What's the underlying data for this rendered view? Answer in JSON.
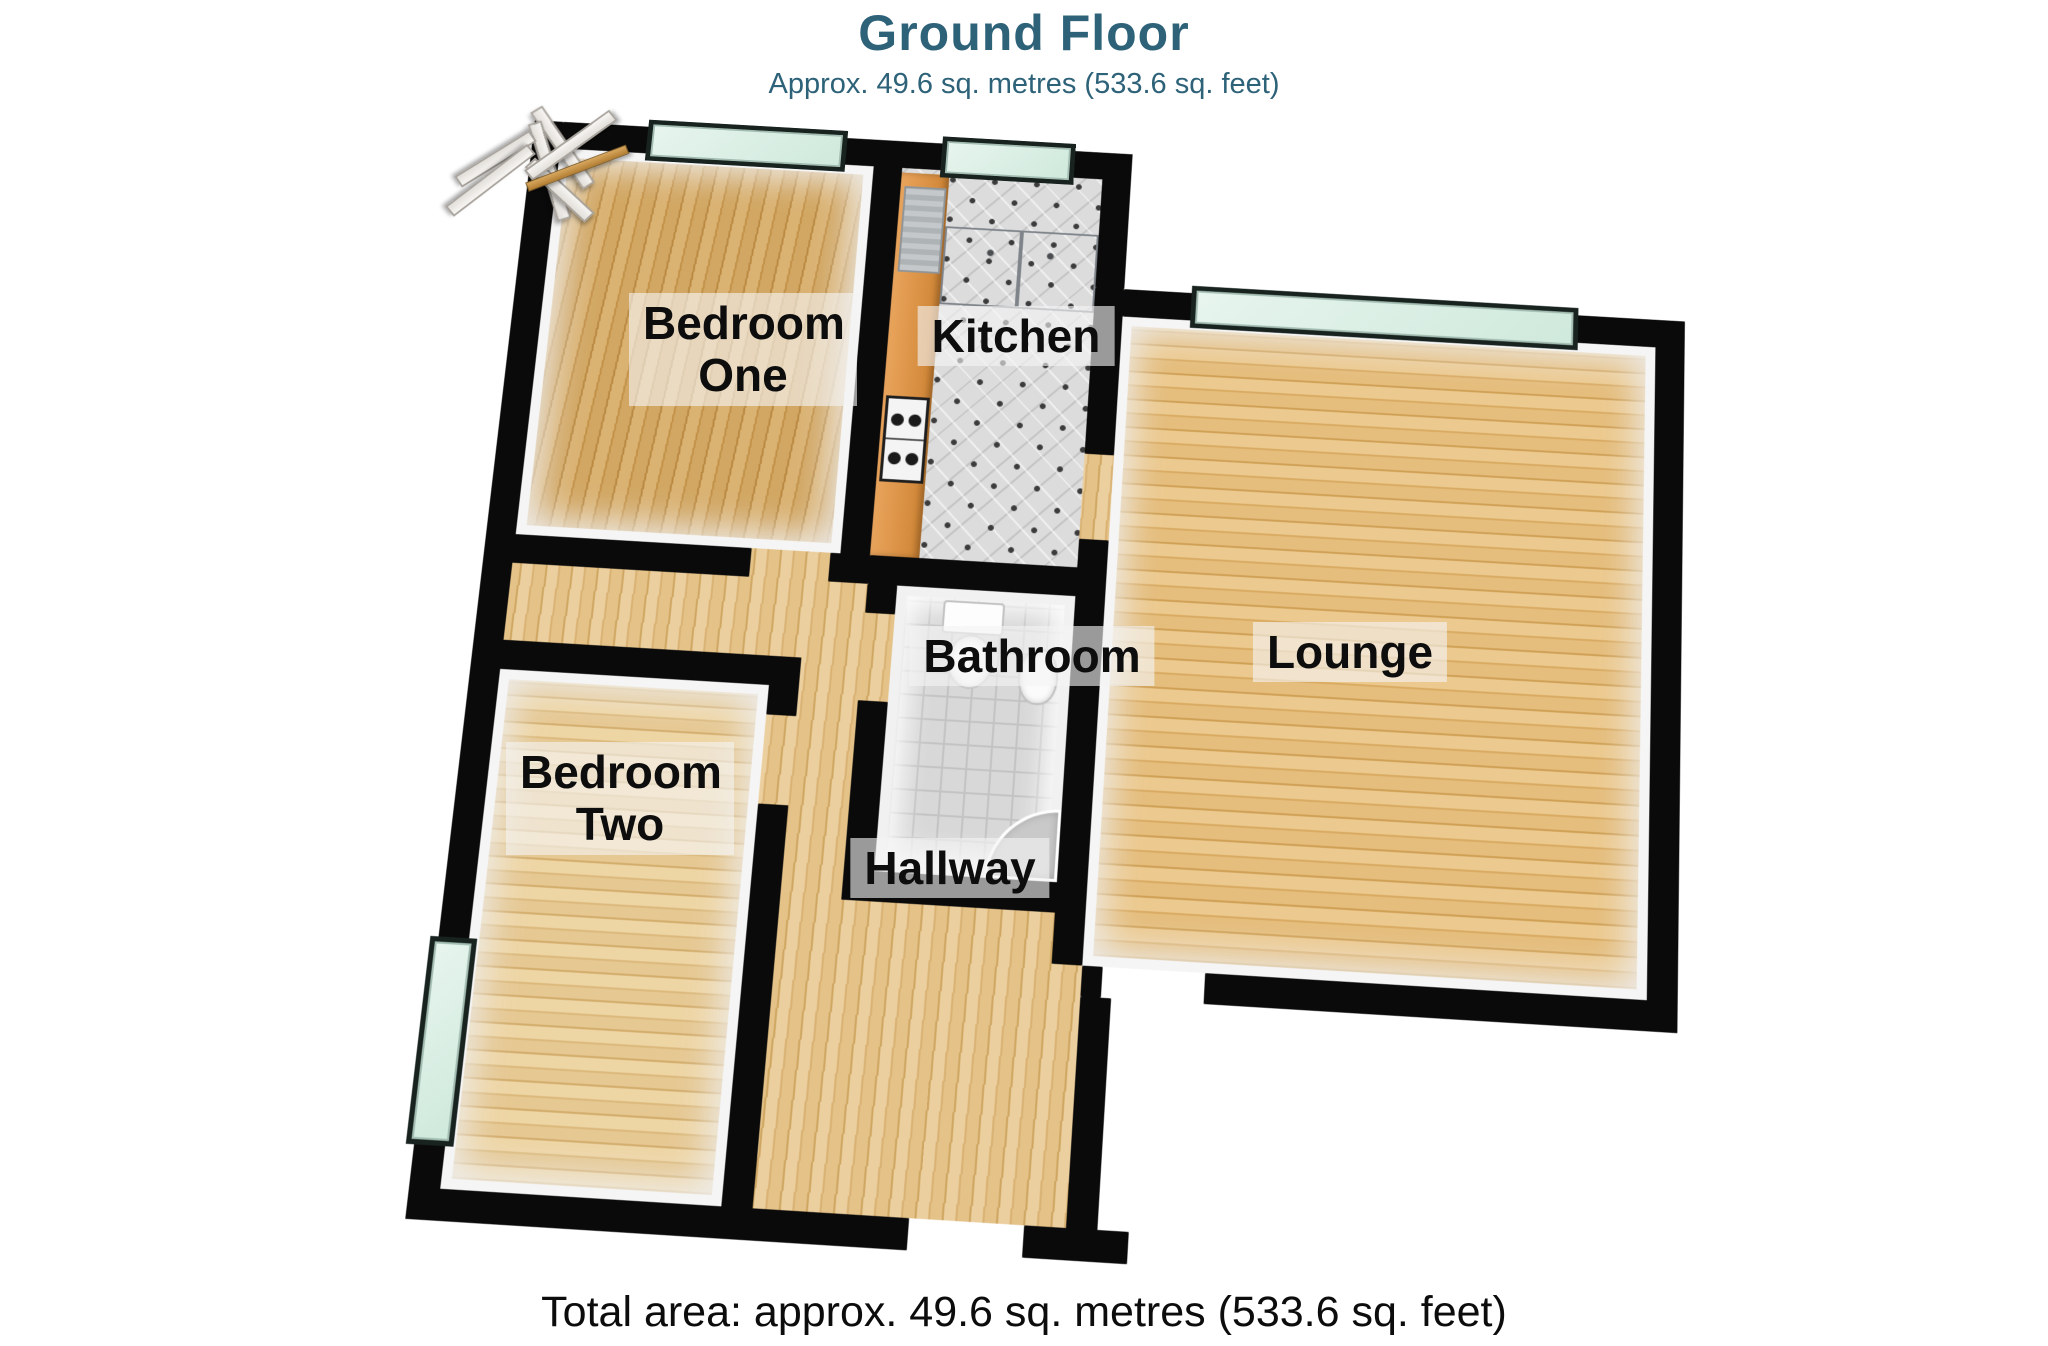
{
  "header": {
    "title": "Ground Floor",
    "subtitle": "Approx. 49.6 sq. metres (533.6 sq. feet)"
  },
  "plan": {
    "rooms": [
      {
        "name": "Bedroom One"
      },
      {
        "name": "Kitchen"
      },
      {
        "name": "Lounge"
      },
      {
        "name": "Bathroom"
      },
      {
        "name": "Bedroom Two"
      },
      {
        "name": "Hallway"
      }
    ],
    "windows": [
      "bedroom-one-window",
      "kitchen-window",
      "lounge-window",
      "bedroom-two-window"
    ],
    "fixtures": [
      "kitchen-counter",
      "gas-hob",
      "kitchen-cabinets",
      "radiator",
      "toilet",
      "basin",
      "corner-shower"
    ],
    "doors": [
      "bedroom-one-door",
      "cupboard-door",
      "bathroom-door",
      "bedroom-two-door",
      "kitchen-lounge-door",
      "lounge-door",
      "front-door"
    ],
    "colors": {
      "title_teal": "#2d6278",
      "wall": "#0a0a0a",
      "window_glass": "#d6ecdf",
      "wood_floor": "#ddb273",
      "kitchen_counter": "#dd9040",
      "kitchen_cabinet": "#a4a9ae",
      "tile": "#dcdcdc",
      "door_white": "#f3f1ee",
      "front_door_gold": "#c59146"
    }
  },
  "footer": {
    "total_area": "Total area: approx. 49.6 sq. metres (533.6 sq. feet)"
  }
}
